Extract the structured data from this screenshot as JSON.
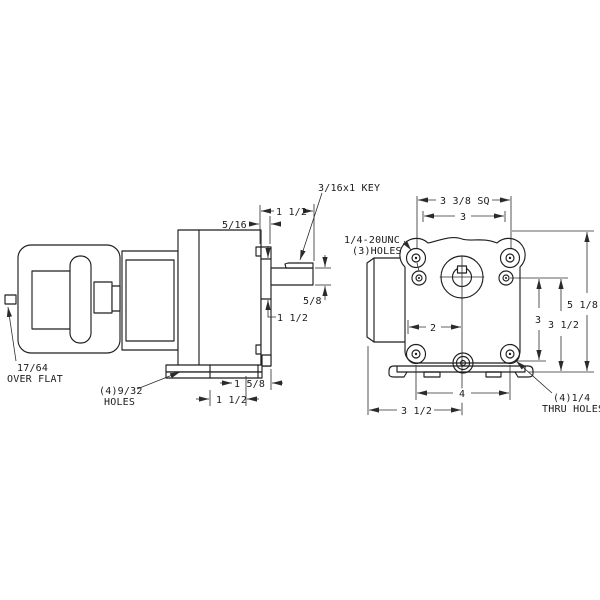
{
  "drawing": {
    "type": "engineering-dimension-drawing",
    "views": [
      "side-view-gearmotor",
      "end-view-mounting-face"
    ],
    "left_view": {
      "labels": {
        "key_callout": "3/16x1 KEY",
        "shaft_length": "1 1/2",
        "face_thickness": "5/16",
        "shaft_diameter": "5/8",
        "hub_diameter": "1 1/2",
        "flat_value": "17/64",
        "flat_caption": "OVER FLAT",
        "base_holes_line1": "(4)9/32",
        "base_holes_line2": "HOLES",
        "base_spacing": "1 1/2",
        "base_to_face": "1 5/8"
      }
    },
    "right_view": {
      "labels": {
        "square_size": "3 3/8 SQ",
        "top_hole_spacing": "3",
        "tapped_holes_line1": "1/4-20UNC",
        "tapped_holes_line2": "(3)HOLES",
        "center_offset": "2",
        "side_hole_span": "3",
        "side_span_mid": "3 1/2",
        "overall_height": "5 1/8",
        "bottom_hole_span": "4",
        "bottom_offset": "3 1/2",
        "thru_holes_line1": "(4)1/4",
        "thru_holes_line2": "THRU HOLES"
      }
    }
  }
}
